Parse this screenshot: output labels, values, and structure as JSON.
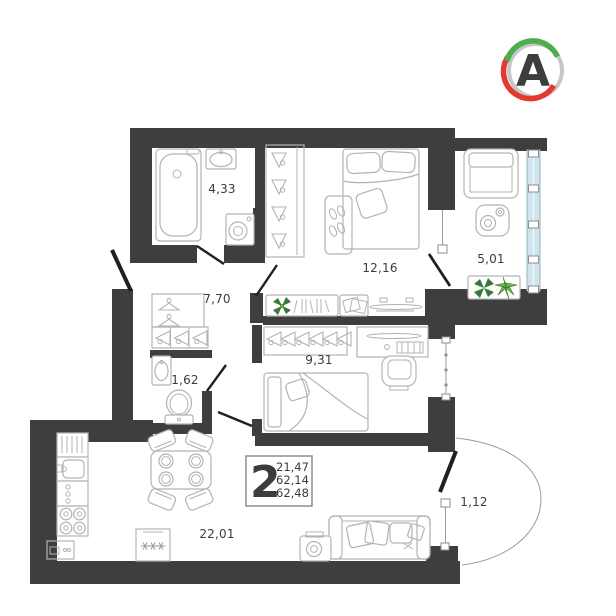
{
  "logo": {
    "letter": "A"
  },
  "info_box": {
    "rooms_count": "2",
    "living_area": "21,47",
    "area_no_balcony": "62,14",
    "total_area": "62,48"
  },
  "rooms": {
    "bathroom": {
      "area": "4,33"
    },
    "bedroom": {
      "area": "12,16"
    },
    "loggia": {
      "area": "5,01"
    },
    "hallway": {
      "area": "7,70"
    },
    "wc": {
      "area": "1,62"
    },
    "kids_room": {
      "area": "9,31"
    },
    "kitchen_living": {
      "area": "22,01"
    },
    "entry_balcony": {
      "area": "1,12"
    }
  },
  "colors": {
    "wall": "#3e3e3e",
    "furniture_line": "#b3b3b3",
    "glazing": "#cfe4ed",
    "plant_dark": "#347a3c",
    "plant_light": "#7cb342",
    "logo_green": "#4cae4e",
    "logo_red": "#e23b2e",
    "logo_gray": "#c7c7c7",
    "text": "#3c3c3c"
  }
}
